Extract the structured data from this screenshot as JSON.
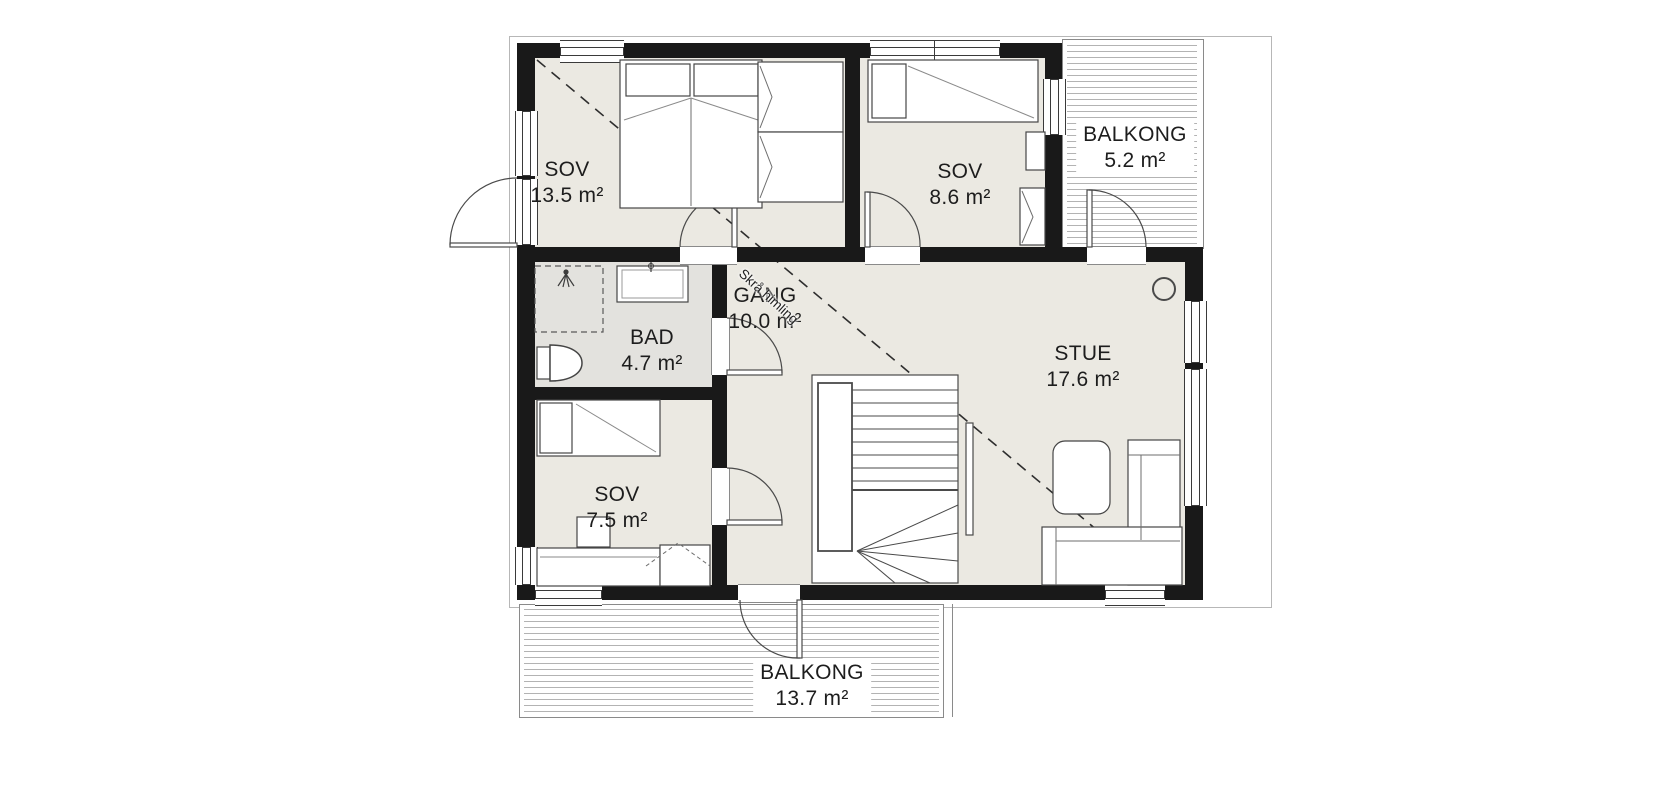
{
  "plan": {
    "colors": {
      "wall": "#191919",
      "room_fill": "#ebe9e2",
      "bath_fill": "#e3e2de",
      "deck_line": "#b3b3b3",
      "line": "#4a4a4a"
    },
    "rooms": [
      {
        "id": "sov1",
        "name": "SOV",
        "area": "13.5 m²"
      },
      {
        "id": "sov2",
        "name": "SOV",
        "area": "8.6 m²"
      },
      {
        "id": "balkong_top",
        "name": "BALKONG",
        "area": "5.2 m²"
      },
      {
        "id": "bad",
        "name": "BAD",
        "area": "4.7 m²"
      },
      {
        "id": "gang",
        "name": "GANG",
        "area": "10.0 m²"
      },
      {
        "id": "stue",
        "name": "STUE",
        "area": "17.6 m²"
      },
      {
        "id": "sov3",
        "name": "SOV",
        "area": "7.5 m²"
      },
      {
        "id": "balkong_bottom",
        "name": "BALKONG",
        "area": "13.7 m²"
      }
    ],
    "annotations": {
      "sloped_ceiling": "Skrå himling"
    }
  }
}
